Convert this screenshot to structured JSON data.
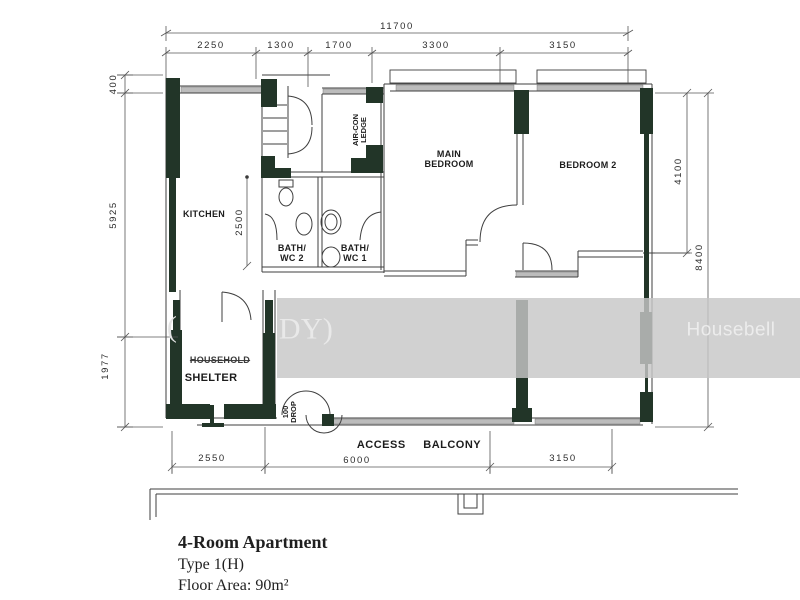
{
  "plan": {
    "dims": {
      "top_total": "11700",
      "top_segments": [
        "2250",
        "1300",
        "1700",
        "3300",
        "3150"
      ],
      "left": [
        "400",
        "5925",
        "1977"
      ],
      "right": [
        "4100",
        "8400"
      ],
      "bottom": [
        "2550",
        "6000",
        "3150"
      ],
      "interior_bath": "2500"
    },
    "rooms": {
      "kitchen": "KITCHEN",
      "bath2_l1": "BATH/",
      "bath2_l2": "WC 2",
      "bath1_l1": "BATH/",
      "bath1_l2": "WC 1",
      "main_l1": "MAIN",
      "main_l2": "BEDROOM",
      "bedroom2": "BEDROOM 2",
      "shelter_l1": "HOUSEHOLD",
      "shelter_l2": "SHELTER",
      "aircon_l1": "AIR-CON",
      "aircon_l2": "LEDGE"
    },
    "annotations": {
      "access_balcony": "ACCESS BALCONY",
      "drop_l1": "100",
      "drop_l2": "DROP"
    },
    "title": {
      "line1": "4-Room Apartment",
      "line2": "Type 1(H)",
      "line3": "Floor Area: 90m²"
    },
    "watermark": {
      "brand": "Housebell",
      "fragment_open": "(",
      "fragment_right": "DY)"
    },
    "colors": {
      "wall": "#223528",
      "line": "#3f3f3f",
      "band": "#c7c7c7"
    }
  }
}
